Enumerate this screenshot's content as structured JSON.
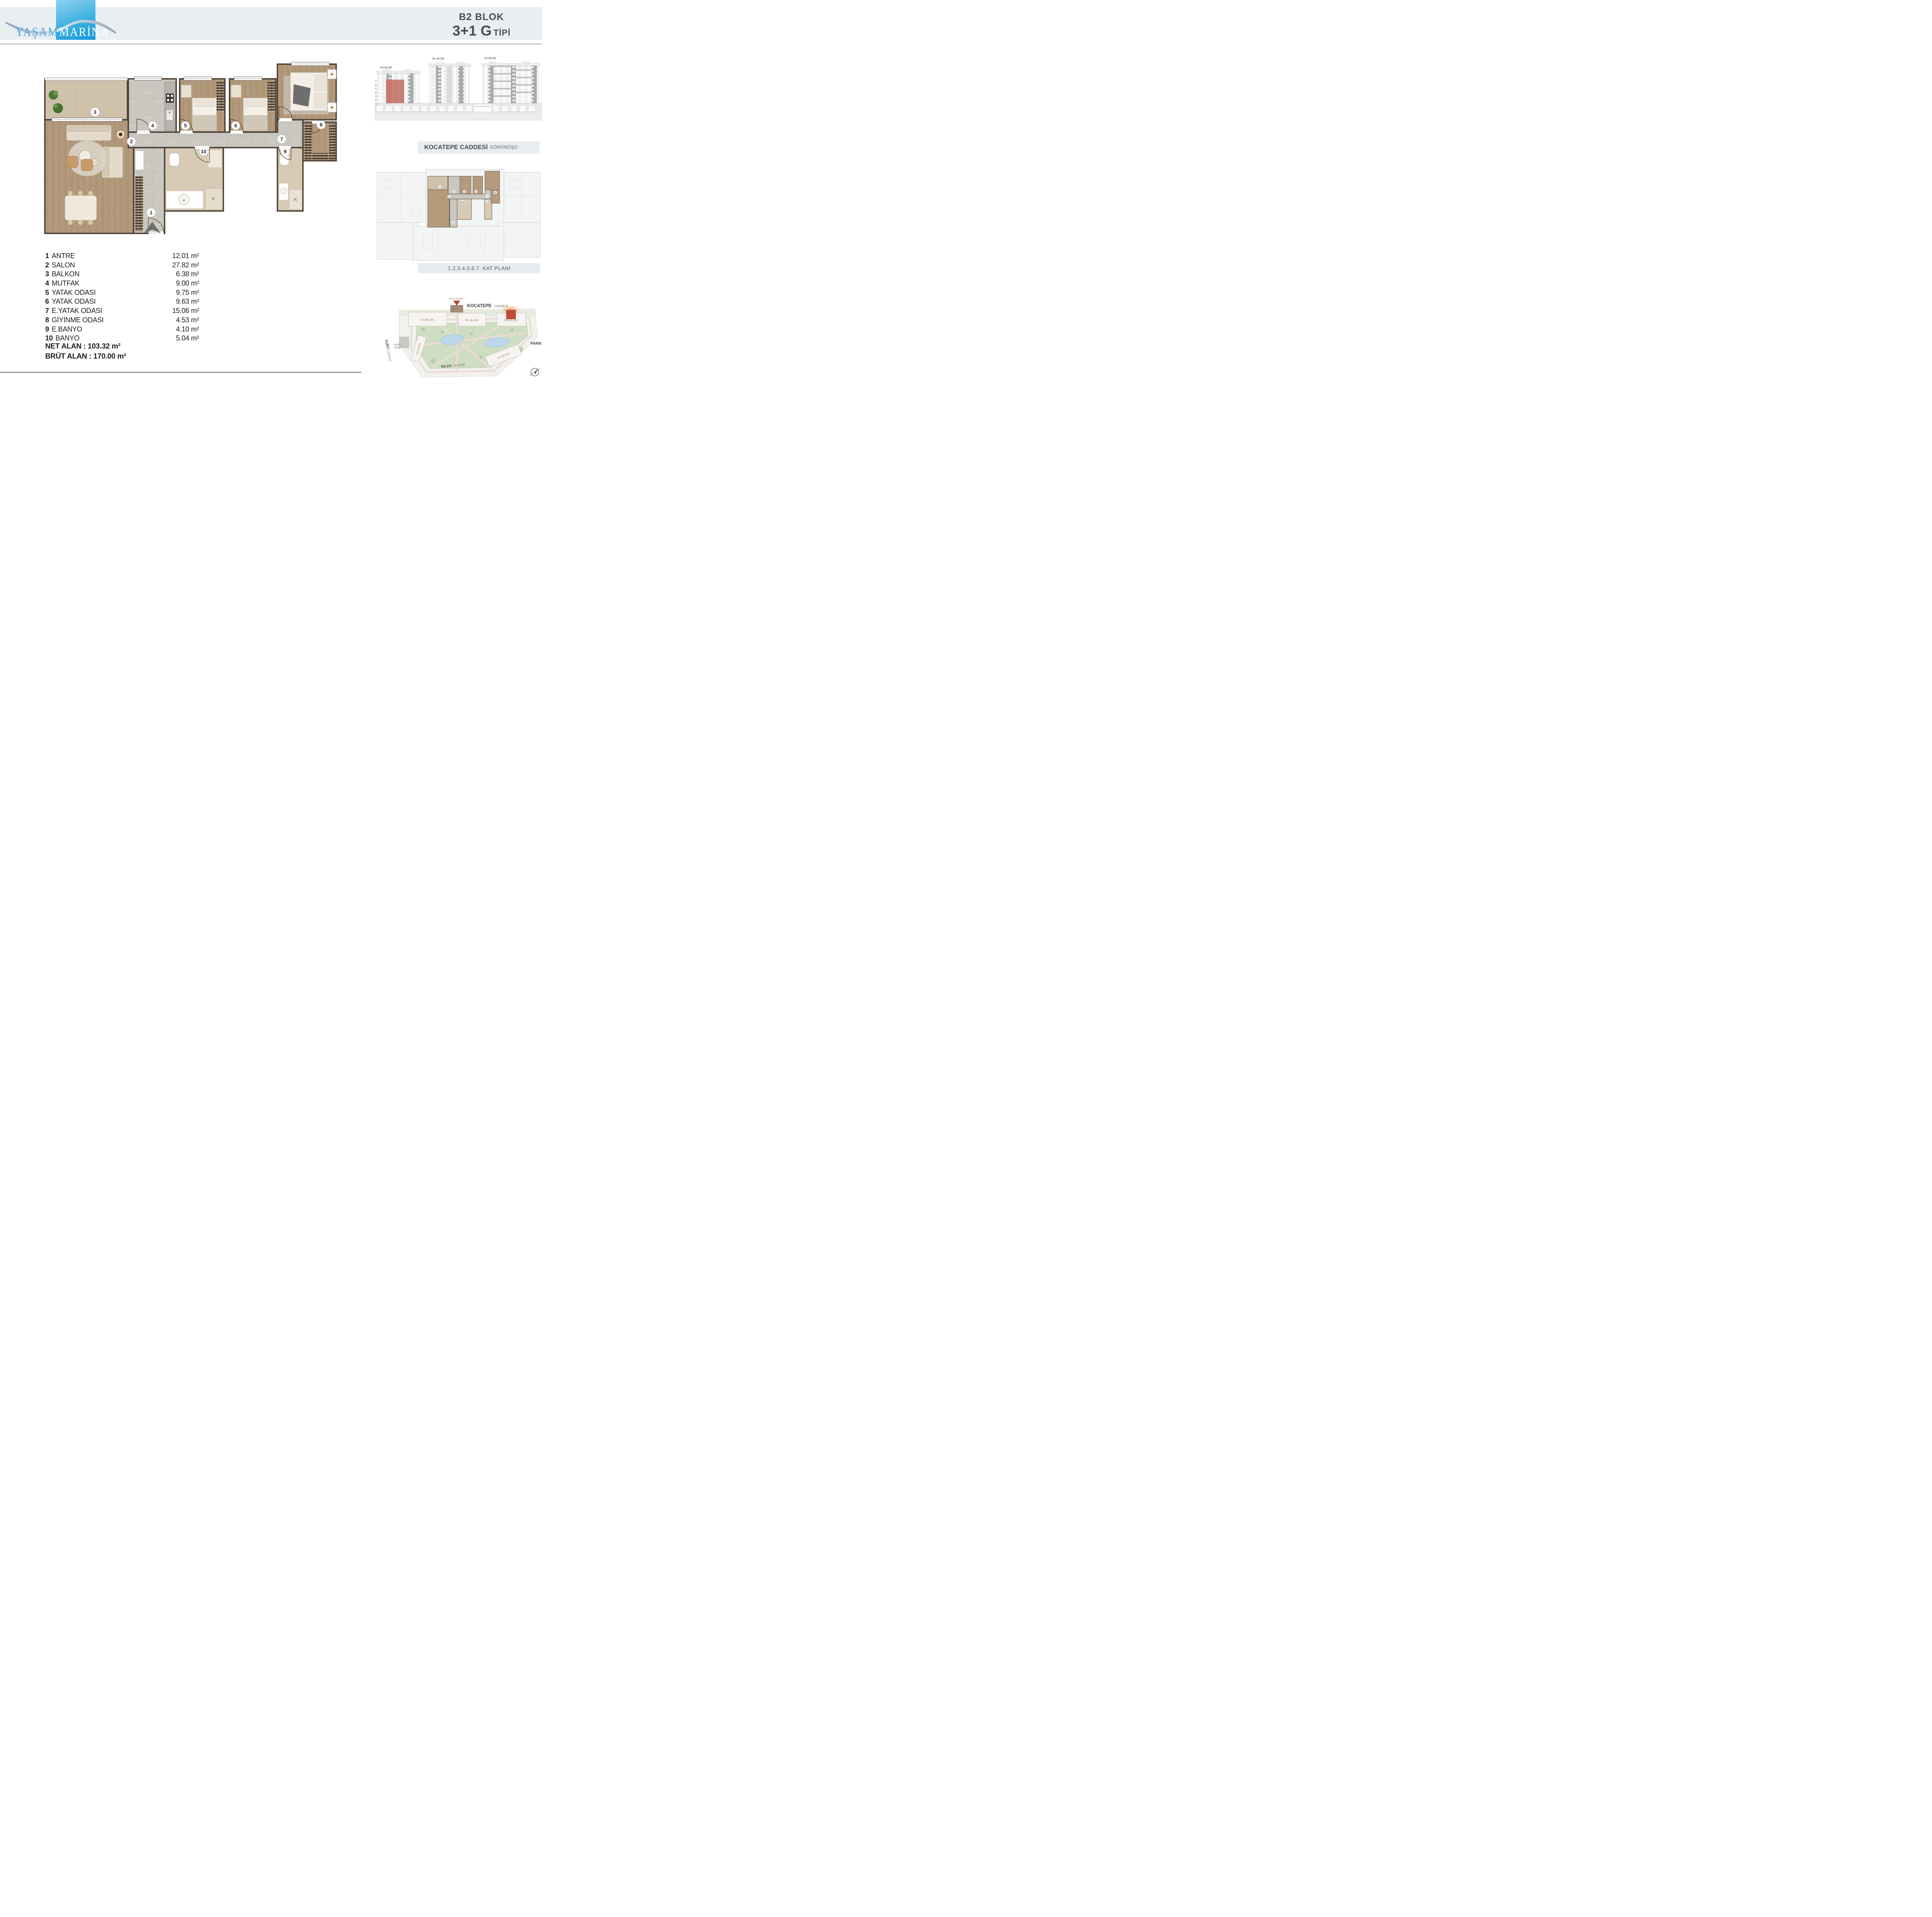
{
  "logo": {
    "word1": "YAŞAM",
    "word2": "MARİNA"
  },
  "header": {
    "block_label": "B2 BLOK",
    "unit_type": "3+1 G",
    "type_suffix": "TİPİ"
  },
  "plan": {
    "numbers": [
      "1",
      "2",
      "3",
      "4",
      "5",
      "6",
      "7",
      "8",
      "9",
      "10"
    ]
  },
  "room_list": [
    {
      "num": "1",
      "label": "ANTRE",
      "area": "12.01 m²"
    },
    {
      "num": "2",
      "label": "SALON",
      "area": "27.82 m²"
    },
    {
      "num": "3",
      "label": "BALKON",
      "area": "6.38 m²"
    },
    {
      "num": "4",
      "label": "MUTFAK",
      "area": "9.00 m²"
    },
    {
      "num": "5",
      "label": "YATAK ODASI",
      "area": "9.75 m²"
    },
    {
      "num": "6",
      "label": "YATAK ODASI",
      "area": "9.63 m²"
    },
    {
      "num": "7",
      "label": "E.YATAK ODASI",
      "area": "15.06 m²"
    },
    {
      "num": "8",
      "label": "GİYİNME ODASI",
      "area": "4.53 m²"
    },
    {
      "num": "9",
      "label": "E.BANYO",
      "area": "4.10 m²"
    },
    {
      "num": "10",
      "label": "BANYO",
      "area": "5.04 m²"
    }
  ],
  "totals": {
    "net": "NET ALAN : 103.32 m²",
    "gross": "BRÜT ALAN : 170.00 m²"
  },
  "elevation": {
    "blocks": {
      "b2": "B2 BLOK",
      "b1": "B1 BLOK",
      "a3": "A3 BLOK"
    },
    "floors": [
      "7",
      "6",
      "5",
      "4",
      "3",
      "2",
      "1"
    ],
    "entrance_sign": "YAŞAM MARİNA",
    "caption_bold": "KOCATEPE CADDESİ",
    "caption_light": "GÖRÜNÜŞÜ"
  },
  "keyplan": {
    "caption": "1.2.3.4.5.6.7. KAT PLANI"
  },
  "siteplan": {
    "entrance": "SİTE GİRİŞİ",
    "street_top_bold": "KOCATEPE",
    "street_top_light": "CADDESİ",
    "blocks": {
      "a3": "A3 BLOK",
      "b1": "B1 BLOK",
      "b2": "B2 BLOK",
      "a2": "A2 BLOK",
      "a1": "A1 BLOK"
    },
    "street_left_bold": "YURT",
    "street_left_light": "CADDESİ",
    "sales_office_line1": "SATIŞ",
    "sales_office_line2": "OFİSİ",
    "park": "PARK",
    "street_bottom_bold": "İHLAS",
    "street_bottom_light": "CADDESİ"
  }
}
